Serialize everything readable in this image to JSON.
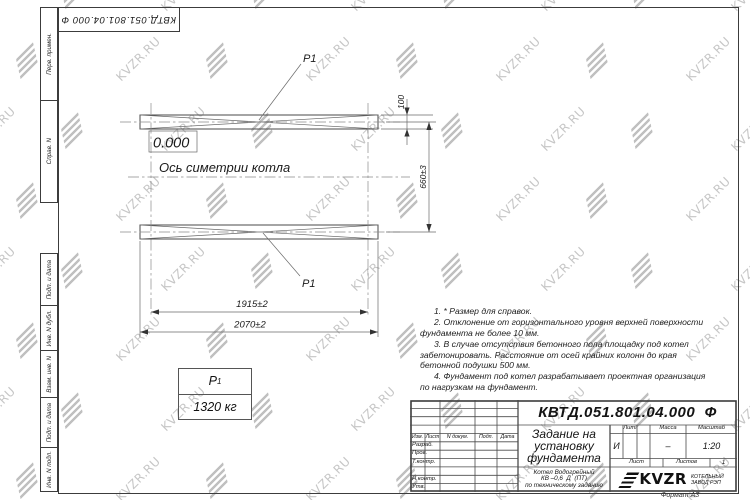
{
  "colors": {
    "line": "#3c3c3c",
    "watermark": "#c6c6c6",
    "paper": "#ffffff"
  },
  "watermark": {
    "text": "KVZR.RU"
  },
  "corner_stamp": {
    "doc_number": "КВТД.051.801.04.000  Ф"
  },
  "side_stamps": {
    "perv": "Перв. примен.",
    "sprav": "Справ. N",
    "podp1": "Подп. и дата",
    "inv_dubl": "Инв. N дубл.",
    "vzam": "Взам. инв. N",
    "podp2": "Подп. и дата",
    "inv_podl": "Инв. N подл."
  },
  "drawing": {
    "elevation": "0.000",
    "axis_label": "Ось симетрии котла",
    "load_top": "Р1",
    "load_bottom": "Р1",
    "dim_width": "100",
    "dim_spacing": "660±3",
    "dim_inner": "1915±2",
    "dim_outer": "2070±2"
  },
  "load_table": {
    "symbol": "Р",
    "sub": "1",
    "value": "1320 кг"
  },
  "notes": [
    "1.  * Размер для справок.",
    "2.  Отклонение от горизонтального уровня верхней поверхности фундамента не более 10 мм.",
    "3.  В случае отсутствия бетонного пола площадку под котел забетонировать. Расстояние от осей крайних колонн до края бетонной подушки 500 мм.",
    "4.  Фундамент под котел разрабатывает проектная организация по нагрузкам на фундамент."
  ],
  "title_block": {
    "doc_number": "КВТД.051.801.04.000  Ф",
    "title_lines": [
      "Задание на",
      "установку",
      "фундамента"
    ],
    "subtitle_lines": [
      "Котел Водогрейный",
      "КВ –0,6  Д  (ПТ)",
      "по техническому заданию"
    ],
    "headers": [
      "Изм.",
      "Лист",
      "N докум.",
      "Подп.",
      "Дата"
    ],
    "rows": [
      "Разраб.",
      "Пров.",
      "Т.контр.",
      "Н.контр.",
      "Утв."
    ],
    "lit_label": "Лит.",
    "lit_value": "И",
    "mass_label": "Масса",
    "mass_value": "–",
    "scale_label": "Масштаб",
    "scale_value": "1:20",
    "sheet_label": "Лист",
    "sheets_label": "Листов",
    "sheets_value": "1",
    "logo_text": "KVZR",
    "logo_sub": [
      "КОТЕЛЬНЫЙ",
      "ЗАВОД РЭП"
    ]
  },
  "format_label": "Формат А3"
}
